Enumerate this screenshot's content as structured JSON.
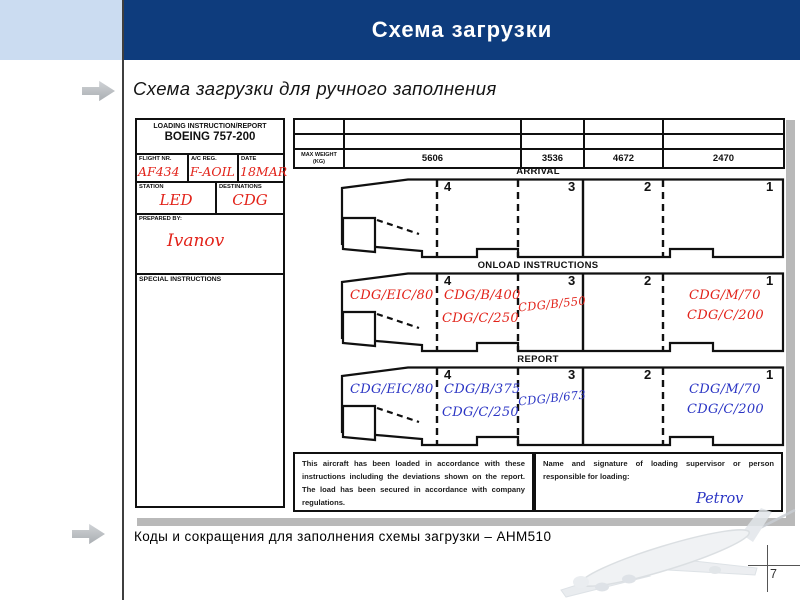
{
  "slide": {
    "title": "Схема загрузки",
    "subtitle": "Схема загрузки для ручного заполнения",
    "caption": "Коды и сокращения для заполнения схемы загрузки – AHM510",
    "page_number": "7"
  },
  "colors": {
    "title_bar": "#0e3c7d",
    "corner_block": "#cbdcf1",
    "ink_red": "#e2231a",
    "ink_blue": "#2b35c4",
    "image_shadow": "#b9b9b9"
  },
  "form": {
    "header": {
      "title": "LOADING INSTRUCTION/REPORT",
      "aircraft_type": "BOEING 757-200"
    },
    "fields": {
      "flight_nr": {
        "label": "FLIGHT NR.",
        "value": "AF434"
      },
      "ac_reg": {
        "label": "A/C REG.",
        "value": "F-AOIL"
      },
      "date": {
        "label": "DATE",
        "value": "18MAR"
      },
      "station": {
        "label": "STATION",
        "value": "LED"
      },
      "destinations": {
        "label": "DESTINATIONS",
        "value": "CDG"
      },
      "prepared_by": {
        "label": "PREPARED BY:",
        "value": "Ivanov"
      },
      "special_instructions": {
        "label": "SPECIAL INSTRUCTIONS",
        "value": ""
      }
    },
    "max_weight": {
      "label": "MAX WEIGHT",
      "unit": "(KG)",
      "values": [
        "5606",
        "3536",
        "4672",
        "2470"
      ]
    },
    "compartments": [
      "4",
      "3",
      "2",
      "1"
    ],
    "sections": {
      "arrival": {
        "label": "ARRIVAL",
        "entries": []
      },
      "onload": {
        "label": "ONLOAD INSTRUCTIONS",
        "entries": [
          {
            "position": "bulk-hold",
            "text": "CDG/EIC/80"
          },
          {
            "position": "compartment-4-line-1",
            "text": "CDG/B/400"
          },
          {
            "position": "compartment-4-line-2",
            "text": "CDG/C/250"
          },
          {
            "position": "compartment-3",
            "text": "CDG/B/550"
          },
          {
            "position": "compartment-1-line-1",
            "text": "CDG/M/70"
          },
          {
            "position": "compartment-1-line-2",
            "text": "CDG/C/200"
          }
        ]
      },
      "report": {
        "label": "REPORT",
        "entries": [
          {
            "position": "bulk-hold",
            "text": "CDG/EIC/80"
          },
          {
            "position": "compartment-4-line-1",
            "text": "CDG/B/375"
          },
          {
            "position": "compartment-4-line-2",
            "text": "CDG/C/250"
          },
          {
            "position": "compartment-3",
            "text": "CDG/B/673"
          },
          {
            "position": "compartment-1-line-1",
            "text": "CDG/M/70"
          },
          {
            "position": "compartment-1-line-2",
            "text": "CDG/C/200"
          }
        ]
      }
    },
    "certification": {
      "text": "This aircraft has been loaded in accordance with these instructions including the deviations shown on the report. The load has been secured in accordance with company regulations."
    },
    "signature": {
      "label": "Name and signature of loading supervisor or person responsible for loading:",
      "value": "Petrov"
    }
  }
}
